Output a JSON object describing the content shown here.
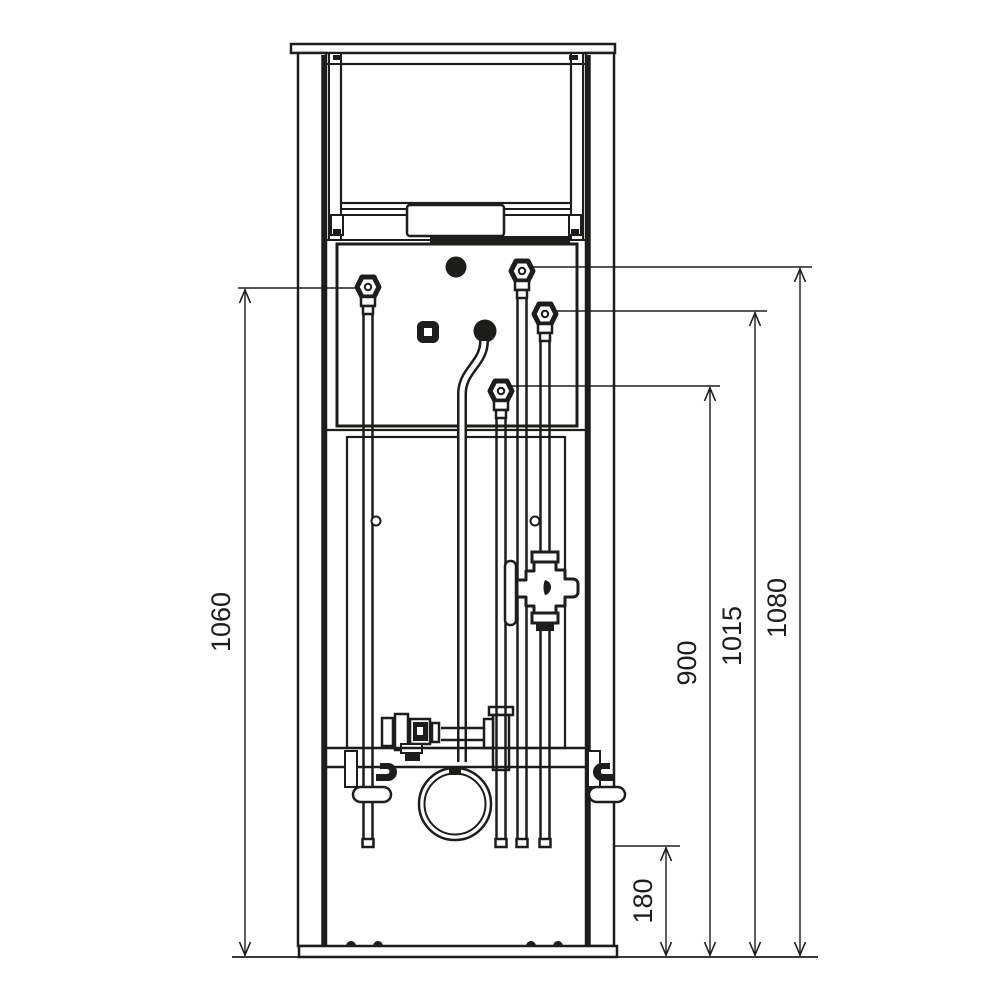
{
  "drawing": {
    "subject": "in-wall sanitary installation frame with cistern and piping, front elevation",
    "background_color": "#ffffff",
    "line_color": "#1d1d1b",
    "dimensions": [
      {
        "id": "dim-1060",
        "value": "1060",
        "side": "left",
        "measures": "left water connection height above floor"
      },
      {
        "id": "dim-900",
        "value": "900",
        "side": "right",
        "measures": "lower center connection height above floor"
      },
      {
        "id": "dim-1015",
        "value": "1015",
        "side": "right",
        "measures": "right lower connection height above floor"
      },
      {
        "id": "dim-1080",
        "value": "1080",
        "side": "right",
        "measures": "right upper connection height above floor"
      },
      {
        "id": "dim-180",
        "value": "180",
        "side": "bottom-right",
        "measures": "pipe end height above floor"
      }
    ]
  }
}
